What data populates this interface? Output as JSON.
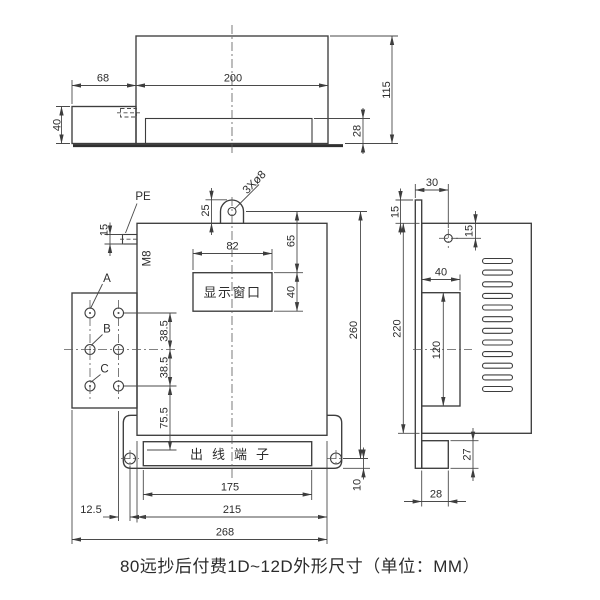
{
  "caption": "80远抄后付费1D~12D外形尺寸（单位：MM）",
  "top_view": {
    "dim_ext_width": "68",
    "dim_body_width": "200",
    "dim_ext_height": "40",
    "dim_total_height": "115",
    "dim_inner_height": "28"
  },
  "front_view": {
    "pe_label": "PE",
    "m8_label": "M8",
    "holes_label": "3Xø8",
    "phase_a": "A",
    "phase_b": "B",
    "phase_c": "C",
    "display_window_label": "显示窗口",
    "terminal_label": "出线端子",
    "dim_lug_height": "25",
    "dim_pe_height": "15",
    "dim_window_width": "82",
    "dim_window_top": "65",
    "dim_window_height": "40",
    "dim_row_spacing_1": "38.5",
    "dim_row_spacing_2": "38.5",
    "dim_row_bottom": "75.5",
    "dim_total_height": "260",
    "dim_hole_offset": "10",
    "dim_terminal_width": "175",
    "dim_body_width": "215",
    "dim_total_width": "268",
    "dim_hole_edge": "12.5"
  },
  "side_view": {
    "dim_top_width": "30",
    "dim_plate_top": "15",
    "dim_hole_top": "15",
    "dim_recess_width": "40",
    "dim_recess_height": "120",
    "dim_body_height": "220",
    "dim_foot_height": "27",
    "dim_foot_width": "28"
  }
}
